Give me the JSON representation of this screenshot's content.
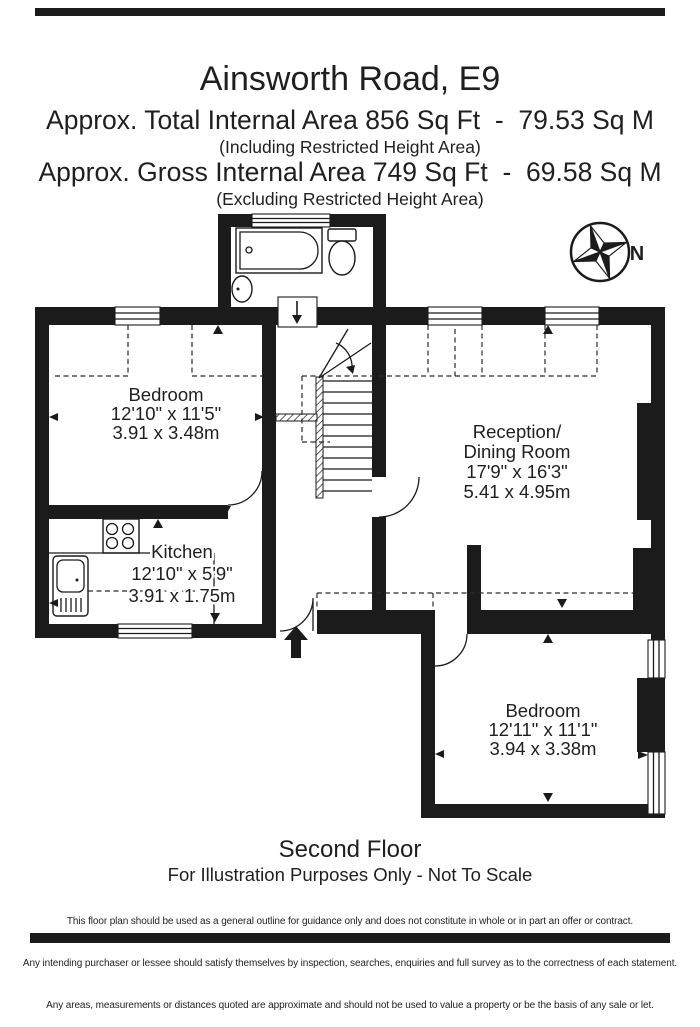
{
  "header": {
    "title": "Ainsworth Road, E9",
    "total_area": "Approx. Total Internal Area 856 Sq Ft  -  79.53 Sq M",
    "total_area_note": "(Including Restricted Height Area)",
    "gross_area": "Approx. Gross Internal Area 749 Sq Ft  -  69.58 Sq M",
    "gross_area_note": "(Excluding Restricted Height Area)"
  },
  "compass": {
    "north_label": "N"
  },
  "rooms": {
    "bedroom_front": {
      "name": "Bedroom",
      "size_imperial": "12'10\" x 11'5\"",
      "size_metric": "3.91 x 3.48m"
    },
    "reception": {
      "name_line1": "Reception/",
      "name_line2": "Dining Room",
      "size_imperial": "17'9\" x 16'3\"",
      "size_metric": "5.41 x 4.95m"
    },
    "kitchen": {
      "name": "Kitchen",
      "size_imperial": "12'10\" x 5'9\"",
      "size_metric": "3.91 x 1.75m"
    },
    "bedroom_rear": {
      "name": "Bedroom",
      "size_imperial": "12'11\" x 11'1\"",
      "size_metric": "3.94 x 3.38m"
    }
  },
  "footer": {
    "floor_label": "Second Floor",
    "scale_note": "For Illustration Purposes Only - Not To Scale",
    "disclaimer_line1": "This floor plan should be used as a general outline for guidance only and does not constitute in whole or in part an offer or contract.",
    "disclaimer_line2": "Any intending purchaser or lessee should satisfy themselves by inspection, searches, enquiries and full survey as to the correctness of each statement.",
    "disclaimer_line3": "Any areas, measurements or distances quoted are approximate and should not be used to value a property or be the basis of any sale or let."
  },
  "colors": {
    "wall": "#1b1b1b",
    "text": "#1f1f1f"
  }
}
